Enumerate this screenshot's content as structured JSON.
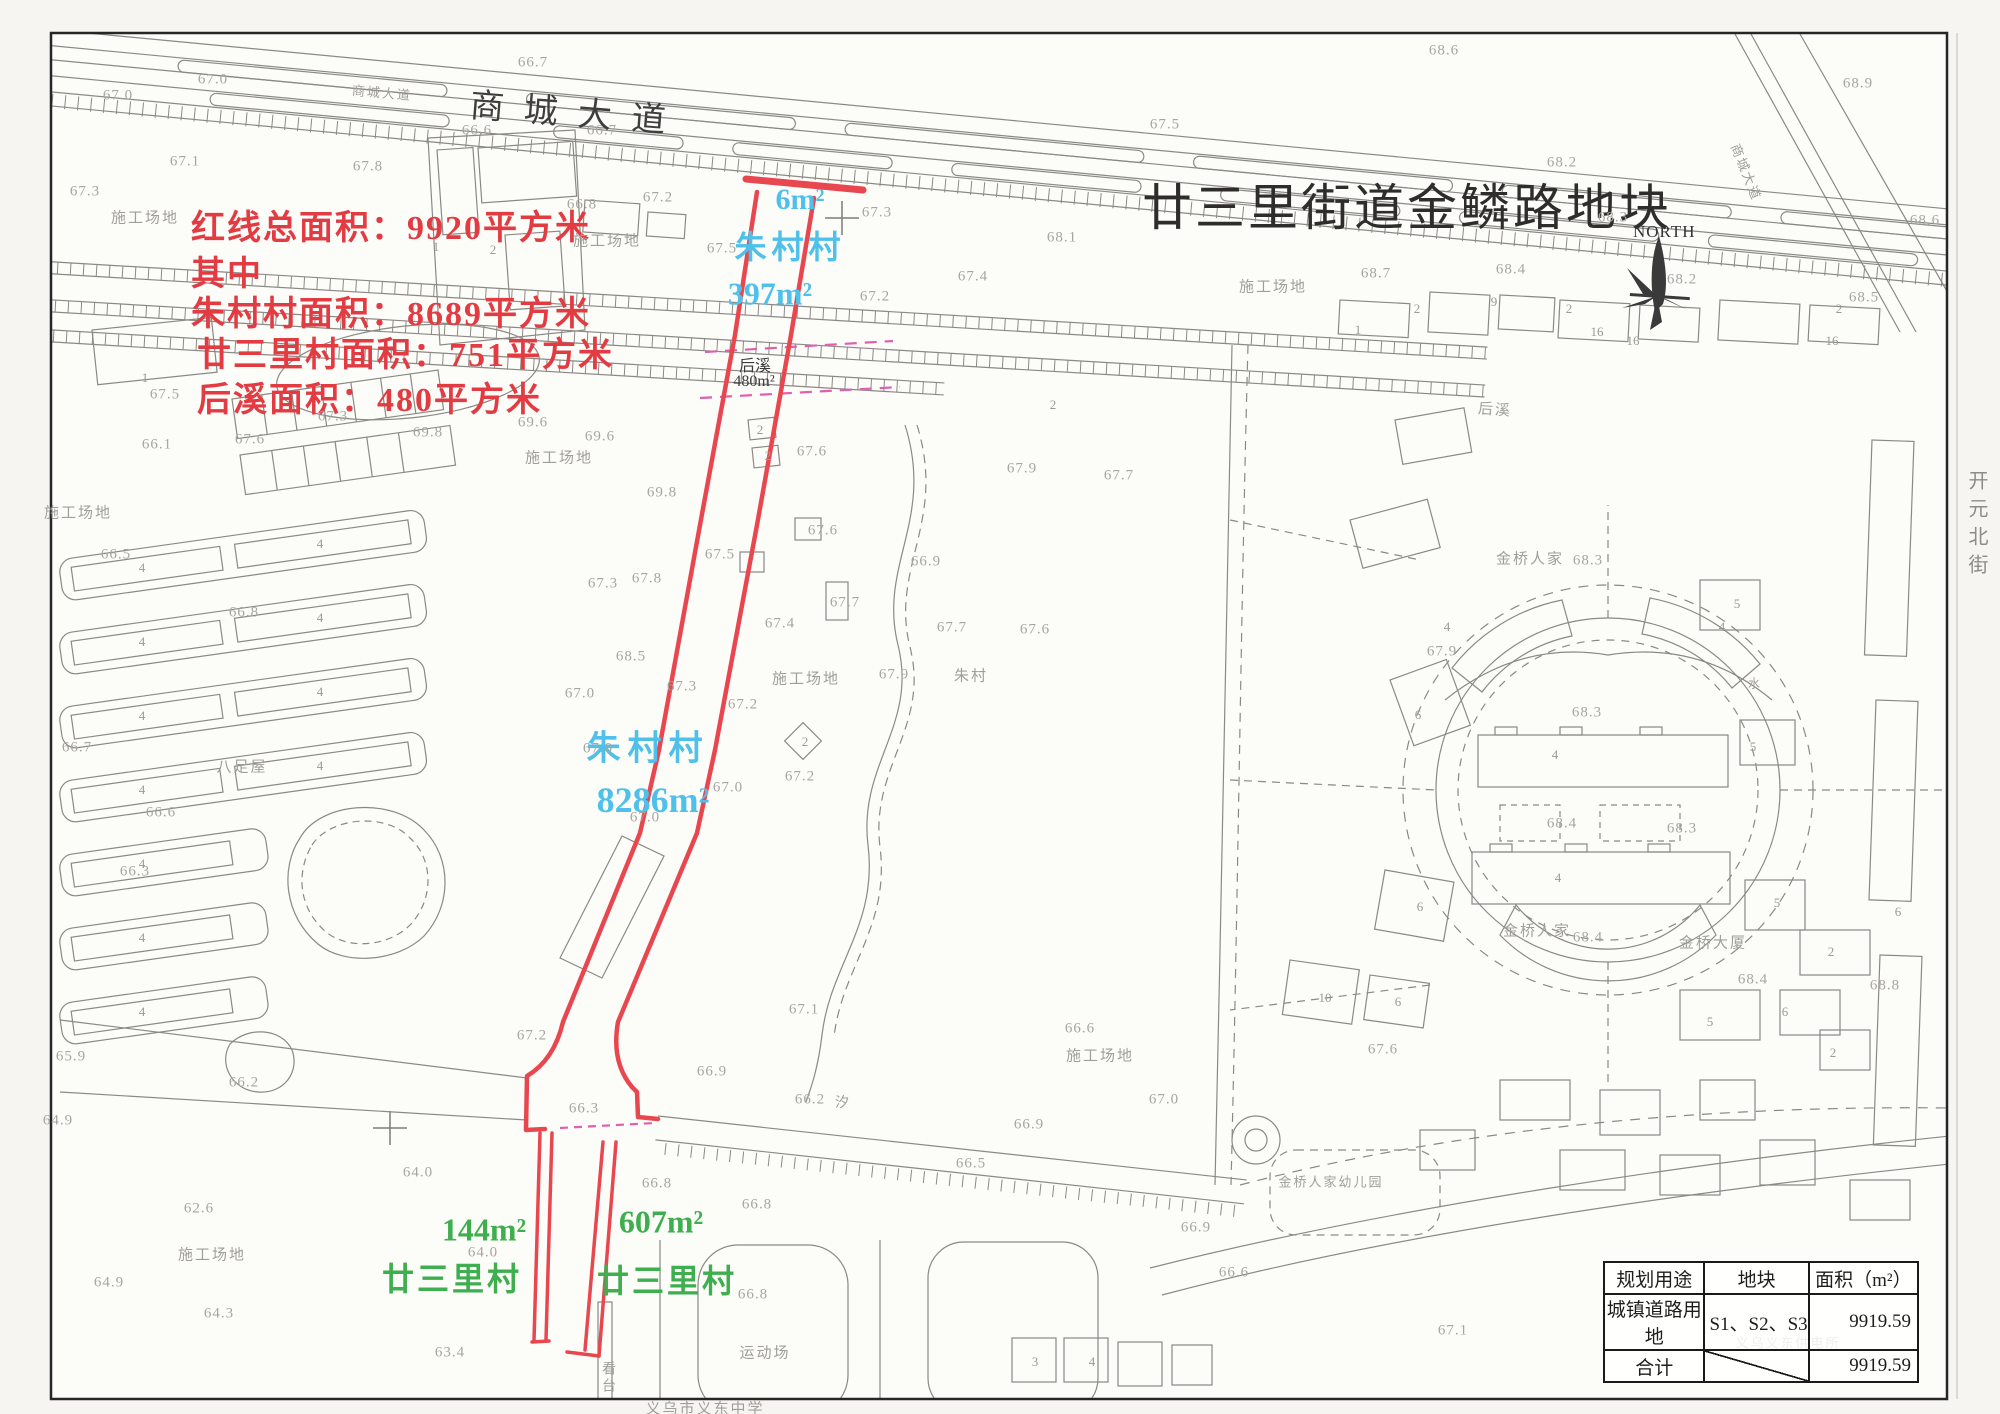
{
  "title": "廿三里街道金鳞路地块",
  "north_label": "NORTH",
  "road_main": "商城大道",
  "side_labels": {
    "kaiyuan": "开元北街"
  },
  "annotation": {
    "color": "#e23b42",
    "lines": [
      "红线总面积：9920平方米",
      "其中",
      "朱村村面积：8689平方米",
      "廿三里村面积：751平方米",
      "后溪面积：480平方米"
    ]
  },
  "parcel_labels": {
    "cyan_color": "#4fc0ea",
    "green_color": "#3fae4e",
    "zhucun_top_area": "6m²",
    "zhucun_top_name": "朱村村",
    "zhucun_top_area2": "397m²",
    "zhucun_mid_name": "朱村村",
    "zhucun_mid_area": "8286m²",
    "houxi_name": "后溪",
    "houxi_area": "480m²",
    "ganshili_left_area": "144m²",
    "ganshili_left_name": "廿三里村",
    "ganshili_right_area": "607m²",
    "ganshili_right_name": "廿三里村"
  },
  "table": {
    "headers": [
      "规划用途",
      "地块",
      "面积（m²）"
    ],
    "rows": [
      [
        "城镇道路用地",
        "S1、S2、S3",
        "9919.59"
      ],
      [
        "合计",
        "",
        "9919.59"
      ]
    ]
  },
  "colors": {
    "red_outline": "#e8474f",
    "magenta_dash": "#e05fae",
    "map_line": "#8b8985",
    "label_gray": "#a09e99"
  },
  "map_labels": [
    {
      "t": "施工场地",
      "x": 145,
      "y": 217
    },
    {
      "t": "施工场地",
      "x": 607,
      "y": 240
    },
    {
      "t": "施工场地",
      "x": 1273,
      "y": 286
    },
    {
      "t": "施工场地",
      "x": 78,
      "y": 512
    },
    {
      "t": "施工场地",
      "x": 559,
      "y": 457
    },
    {
      "t": "施工场地",
      "x": 806,
      "y": 678
    },
    {
      "t": "施工场地",
      "x": 1100,
      "y": 1055
    },
    {
      "t": "施工场地",
      "x": 212,
      "y": 1254
    },
    {
      "t": "八足屋",
      "x": 242,
      "y": 766
    },
    {
      "t": "朱村",
      "x": 971,
      "y": 675
    },
    {
      "t": "后溪",
      "x": 1495,
      "y": 409,
      "r": 4
    },
    {
      "t": "金桥人家",
      "x": 1530,
      "y": 558
    },
    {
      "t": "金桥人家",
      "x": 1537,
      "y": 930
    },
    {
      "t": "金桥大厦",
      "x": 1713,
      "y": 942
    },
    {
      "t": "金桥人家幼儿园",
      "x": 1331,
      "y": 1181,
      "s": 13
    },
    {
      "t": "运动场",
      "x": 765,
      "y": 1352
    },
    {
      "t": "看台",
      "x": 607,
      "y": 1378,
      "v": 1,
      "s": 14
    },
    {
      "t": "义乌市义东中学",
      "x": 705,
      "y": 1408
    },
    {
      "t": "义乌义东供电所",
      "x": 1788,
      "y": 1342,
      "s": 13
    },
    {
      "t": "商城大道",
      "x": 382,
      "y": 92,
      "r": 5,
      "s": 13
    },
    {
      "t": "商城大道",
      "x": 1747,
      "y": 172,
      "r": 68,
      "s": 13
    },
    {
      "t": "汐",
      "x": 843,
      "y": 1102,
      "s": 14
    },
    {
      "t": "水",
      "x": 1755,
      "y": 683,
      "s": 12
    }
  ],
  "elevations": [
    {
      "t": "67.0",
      "x": 213,
      "y": 80
    },
    {
      "t": "67.0",
      "x": 118,
      "y": 96
    },
    {
      "t": "66.7",
      "x": 533,
      "y": 63
    },
    {
      "t": "66.6",
      "x": 477,
      "y": 131
    },
    {
      "t": "66.7",
      "x": 602,
      "y": 131
    },
    {
      "t": "67.5",
      "x": 1165,
      "y": 125
    },
    {
      "t": "67.1",
      "x": 185,
      "y": 162
    },
    {
      "t": "67.8",
      "x": 368,
      "y": 167
    },
    {
      "t": "67.3",
      "x": 85,
      "y": 192
    },
    {
      "t": "68.6",
      "x": 1444,
      "y": 51
    },
    {
      "t": "68.9",
      "x": 1858,
      "y": 84
    },
    {
      "t": "68.2",
      "x": 1562,
      "y": 163
    },
    {
      "t": "68.6",
      "x": 1925,
      "y": 221
    },
    {
      "t": "66.8",
      "x": 582,
      "y": 205
    },
    {
      "t": "67.2",
      "x": 658,
      "y": 198
    },
    {
      "t": "67.3",
      "x": 877,
      "y": 213
    },
    {
      "t": "67.5",
      "x": 722,
      "y": 249
    },
    {
      "t": "67.4",
      "x": 973,
      "y": 277
    },
    {
      "t": "67.2",
      "x": 875,
      "y": 297
    },
    {
      "t": "68.1",
      "x": 1062,
      "y": 238
    },
    {
      "t": "68.7",
      "x": 1376,
      "y": 274
    },
    {
      "t": "68.4",
      "x": 1511,
      "y": 270
    },
    {
      "t": "68.5",
      "x": 1864,
      "y": 298
    },
    {
      "t": "68.2",
      "x": 1682,
      "y": 280
    },
    {
      "t": "68.3",
      "x": 1613,
      "y": 218
    },
    {
      "t": "67.5",
      "x": 165,
      "y": 395
    },
    {
      "t": "67.3",
      "x": 333,
      "y": 417
    },
    {
      "t": "67.6",
      "x": 250,
      "y": 440
    },
    {
      "t": "66.1",
      "x": 157,
      "y": 445
    },
    {
      "t": "69.8",
      "x": 428,
      "y": 433
    },
    {
      "t": "69.6",
      "x": 533,
      "y": 423
    },
    {
      "t": "69.6",
      "x": 600,
      "y": 437
    },
    {
      "t": "69.8",
      "x": 662,
      "y": 493
    },
    {
      "t": "67.6",
      "x": 812,
      "y": 452
    },
    {
      "t": "67.5",
      "x": 720,
      "y": 555
    },
    {
      "t": "67.6",
      "x": 823,
      "y": 531
    },
    {
      "t": "67.7",
      "x": 845,
      "y": 603
    },
    {
      "t": "67.4",
      "x": 780,
      "y": 624
    },
    {
      "t": "67.8",
      "x": 647,
      "y": 579
    },
    {
      "t": "67.3",
      "x": 603,
      "y": 584
    },
    {
      "t": "68.5",
      "x": 631,
      "y": 657
    },
    {
      "t": "67.0",
      "x": 580,
      "y": 694
    },
    {
      "t": "67.3",
      "x": 682,
      "y": 687
    },
    {
      "t": "67.2",
      "x": 743,
      "y": 705
    },
    {
      "t": "67.0",
      "x": 598,
      "y": 749
    },
    {
      "t": "67.2",
      "x": 800,
      "y": 777
    },
    {
      "t": "67.0",
      "x": 728,
      "y": 788
    },
    {
      "t": "67.0",
      "x": 645,
      "y": 818
    },
    {
      "t": "66.5",
      "x": 116,
      "y": 555
    },
    {
      "t": "66.8",
      "x": 244,
      "y": 613
    },
    {
      "t": "66.7",
      "x": 77,
      "y": 748
    },
    {
      "t": "66.6",
      "x": 161,
      "y": 813
    },
    {
      "t": "66.3",
      "x": 135,
      "y": 872
    },
    {
      "t": "65.9",
      "x": 71,
      "y": 1057
    },
    {
      "t": "66.2",
      "x": 244,
      "y": 1083
    },
    {
      "t": "64.9",
      "x": 58,
      "y": 1121
    },
    {
      "t": "64.0",
      "x": 418,
      "y": 1173
    },
    {
      "t": "62.6",
      "x": 199,
      "y": 1209
    },
    {
      "t": "64.9",
      "x": 109,
      "y": 1283
    },
    {
      "t": "64.3",
      "x": 219,
      "y": 1314
    },
    {
      "t": "63.4",
      "x": 450,
      "y": 1353
    },
    {
      "t": "64.0",
      "x": 483,
      "y": 1253
    },
    {
      "t": "66.8",
      "x": 757,
      "y": 1205
    },
    {
      "t": "66.8",
      "x": 753,
      "y": 1295
    },
    {
      "t": "67.2",
      "x": 532,
      "y": 1036
    },
    {
      "t": "66.9",
      "x": 712,
      "y": 1072
    },
    {
      "t": "66.3",
      "x": 584,
      "y": 1109
    },
    {
      "t": "66.8",
      "x": 657,
      "y": 1184
    },
    {
      "t": "66.9",
      "x": 1196,
      "y": 1228
    },
    {
      "t": "66.6",
      "x": 1234,
      "y": 1273
    },
    {
      "t": "67.1",
      "x": 1453,
      "y": 1331
    },
    {
      "t": "67.9",
      "x": 1442,
      "y": 652
    },
    {
      "t": "68.3",
      "x": 1588,
      "y": 561
    },
    {
      "t": "68.3",
      "x": 1587,
      "y": 713
    },
    {
      "t": "68.4",
      "x": 1562,
      "y": 824
    },
    {
      "t": "68.3",
      "x": 1682,
      "y": 829
    },
    {
      "t": "68.4",
      "x": 1588,
      "y": 938
    },
    {
      "t": "68.4",
      "x": 1753,
      "y": 980
    },
    {
      "t": "68.8",
      "x": 1885,
      "y": 986
    },
    {
      "t": "67.6",
      "x": 1383,
      "y": 1050
    },
    {
      "t": "67.9",
      "x": 1022,
      "y": 469
    },
    {
      "t": "67.7",
      "x": 1119,
      "y": 476
    },
    {
      "t": "66.9",
      "x": 926,
      "y": 562
    },
    {
      "t": "67.7",
      "x": 952,
      "y": 628
    },
    {
      "t": "67.6",
      "x": 1035,
      "y": 630
    },
    {
      "t": "67.9",
      "x": 894,
      "y": 675
    },
    {
      "t": "67.1",
      "x": 804,
      "y": 1010
    },
    {
      "t": "67.0",
      "x": 1164,
      "y": 1100
    },
    {
      "t": "66.6",
      "x": 1080,
      "y": 1029
    },
    {
      "t": "66.2",
      "x": 810,
      "y": 1100
    },
    {
      "t": "66.5",
      "x": 971,
      "y": 1164
    },
    {
      "t": "66.9",
      "x": 1029,
      "y": 1125
    }
  ],
  "building_numbers": [
    {
      "t": "4",
      "x": 142,
      "y": 568
    },
    {
      "t": "4",
      "x": 320,
      "y": 544
    },
    {
      "t": "4",
      "x": 142,
      "y": 642
    },
    {
      "t": "4",
      "x": 320,
      "y": 618
    },
    {
      "t": "4",
      "x": 142,
      "y": 716
    },
    {
      "t": "4",
      "x": 320,
      "y": 692
    },
    {
      "t": "4",
      "x": 142,
      "y": 790
    },
    {
      "t": "4",
      "x": 320,
      "y": 766
    },
    {
      "t": "4",
      "x": 142,
      "y": 864
    },
    {
      "t": "4",
      "x": 142,
      "y": 938
    },
    {
      "t": "4",
      "x": 142,
      "y": 1012
    },
    {
      "t": "1",
      "x": 145,
      "y": 378
    },
    {
      "t": "1",
      "x": 436,
      "y": 247
    },
    {
      "t": "2",
      "x": 493,
      "y": 250
    },
    {
      "t": "2",
      "x": 760,
      "y": 430
    },
    {
      "t": "2",
      "x": 768,
      "y": 456
    },
    {
      "t": "2",
      "x": 805,
      "y": 742
    },
    {
      "t": "16",
      "x": 1597,
      "y": 332
    },
    {
      "t": "2",
      "x": 1417,
      "y": 309
    },
    {
      "t": "9",
      "x": 1494,
      "y": 302
    },
    {
      "t": "2",
      "x": 1569,
      "y": 309
    },
    {
      "t": "16",
      "x": 1633,
      "y": 341
    },
    {
      "t": "2",
      "x": 1839,
      "y": 309
    },
    {
      "t": "16",
      "x": 1832,
      "y": 341
    },
    {
      "t": "1",
      "x": 1358,
      "y": 330
    },
    {
      "t": "6",
      "x": 1418,
      "y": 715
    },
    {
      "t": "6",
      "x": 1420,
      "y": 907
    },
    {
      "t": "5",
      "x": 1737,
      "y": 604
    },
    {
      "t": "5",
      "x": 1753,
      "y": 747
    },
    {
      "t": "5",
      "x": 1777,
      "y": 903
    },
    {
      "t": "2",
      "x": 1831,
      "y": 952
    },
    {
      "t": "6",
      "x": 1898,
      "y": 912
    },
    {
      "t": "5",
      "x": 1710,
      "y": 1022
    },
    {
      "t": "6",
      "x": 1785,
      "y": 1012
    },
    {
      "t": "2",
      "x": 1833,
      "y": 1053
    },
    {
      "t": "10",
      "x": 1325,
      "y": 998
    },
    {
      "t": "6",
      "x": 1398,
      "y": 1002
    },
    {
      "t": "4",
      "x": 1555,
      "y": 755
    },
    {
      "t": "4",
      "x": 1558,
      "y": 878
    },
    {
      "t": "2",
      "x": 1053,
      "y": 405
    },
    {
      "t": "3",
      "x": 1035,
      "y": 1362
    },
    {
      "t": "4",
      "x": 1092,
      "y": 1362
    },
    {
      "t": "4",
      "x": 1447,
      "y": 627
    },
    {
      "t": "4",
      "x": 1722,
      "y": 627
    }
  ]
}
